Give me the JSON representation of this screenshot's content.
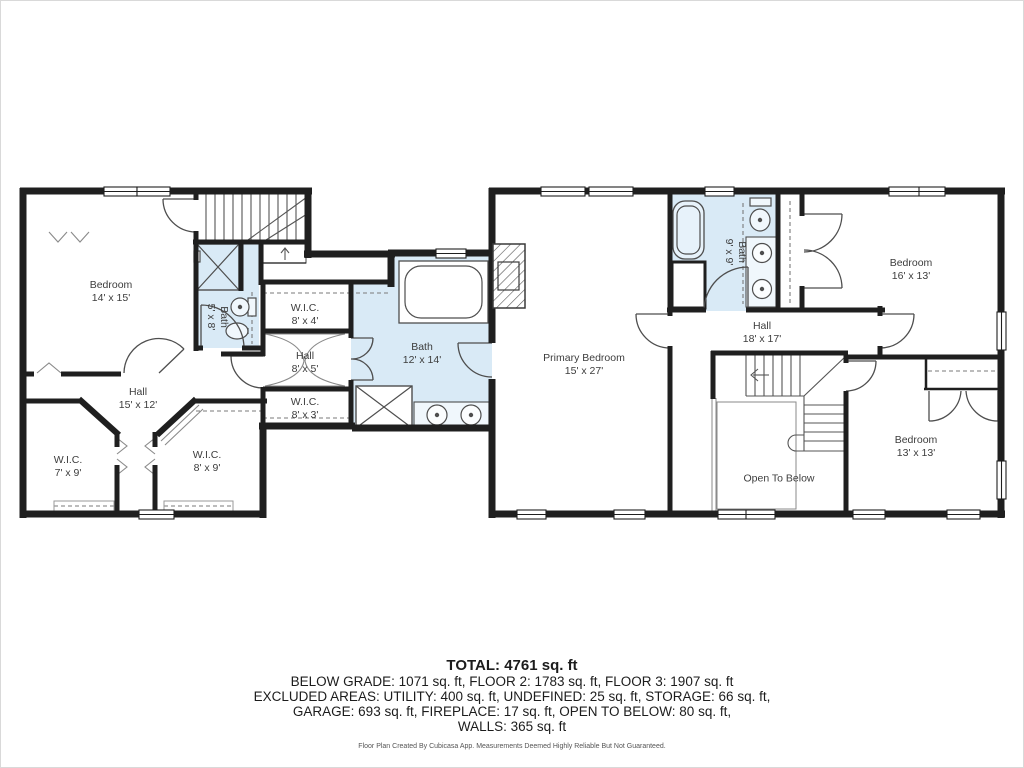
{
  "rooms": {
    "bedroom_left": {
      "name": "Bedroom",
      "dims": "14' x 15'"
    },
    "bath_small": {
      "name": "Bath",
      "dims": "5' x 8'"
    },
    "wic_8x4": {
      "name": "W.I.C.",
      "dims": "8' x 4'"
    },
    "hall_8x5": {
      "name": "Hall",
      "dims": "8' x 5'"
    },
    "wic_8x3": {
      "name": "W.I.C.",
      "dims": "8' x 3'"
    },
    "bath_primary": {
      "name": "Bath",
      "dims": "12' x 14'"
    },
    "hall_15x12": {
      "name": "Hall",
      "dims": "15' x 12'"
    },
    "wic_7x9": {
      "name": "W.I.C.",
      "dims": "7' x 9'"
    },
    "wic_8x9": {
      "name": "W.I.C.",
      "dims": "8' x 9'"
    },
    "primary_bedroom": {
      "name": "Primary Bedroom",
      "dims": "15' x 27'"
    },
    "bath_9x9": {
      "name": "Bath",
      "dims": "9' x 9'"
    },
    "hall_18x17": {
      "name": "Hall",
      "dims": "18' x 17'"
    },
    "bedroom_16x13": {
      "name": "Bedroom",
      "dims": "16' x 13'"
    },
    "bedroom_13x13": {
      "name": "Bedroom",
      "dims": "13' x 13'"
    },
    "open_to_below": {
      "name": "Open To Below"
    }
  },
  "summary": {
    "total": "TOTAL: 4761 sq. ft",
    "line2": "BELOW GRADE: 1071 sq. ft, FLOOR 2: 1783 sq. ft, FLOOR 3: 1907 sq. ft",
    "line3": "EXCLUDED AREAS: UTILITY: 400 sq. ft, UNDEFINED: 25 sq. ft, STORAGE: 66 sq. ft,",
    "line4": "GARAGE: 693 sq. ft, FIREPLACE: 17 sq. ft, OPEN TO BELOW: 80 sq. ft,",
    "line5": "WALLS: 365 sq. ft"
  },
  "footer": "Floor Plan Created By Cubicasa App. Measurements Deemed Highly Reliable But Not Guaranteed.",
  "colors": {
    "wall": "#1f1f1f",
    "bath_fill": "#d9eaf6",
    "fixture_line": "#4e4e4e"
  }
}
